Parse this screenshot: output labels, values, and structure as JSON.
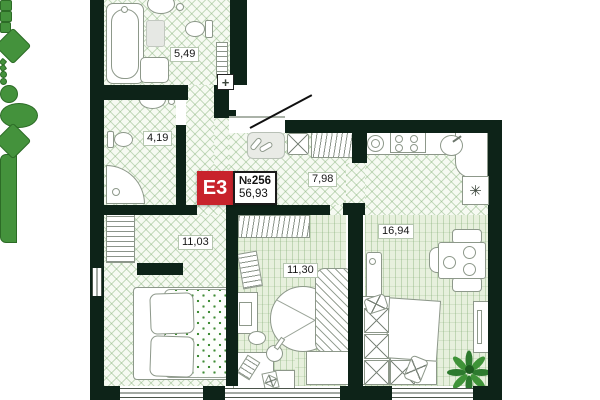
{
  "plan": {
    "badge": {
      "type_label": "E3",
      "number_label": "№256",
      "total_area": "56,93",
      "badge_color": "#c8232c"
    },
    "rooms": [
      {
        "key": "bathroom-top",
        "area": "5,49"
      },
      {
        "key": "bathroom-small",
        "area": "4,19"
      },
      {
        "key": "hallway",
        "area": "7,98"
      },
      {
        "key": "bedroom-left",
        "area": "11,03"
      },
      {
        "key": "bedroom-middle",
        "area": "11,30"
      },
      {
        "key": "kitchen-living",
        "area": "16,94"
      }
    ],
    "symbols": {
      "electrical_panel": "+",
      "ventilation": "✳"
    },
    "colors": {
      "wall": "#0d2318",
      "accent_green": "#44923c",
      "badge_red": "#c8232c",
      "tile_line": "#cfe0c8",
      "room_floor": "#e7f0dd"
    }
  }
}
